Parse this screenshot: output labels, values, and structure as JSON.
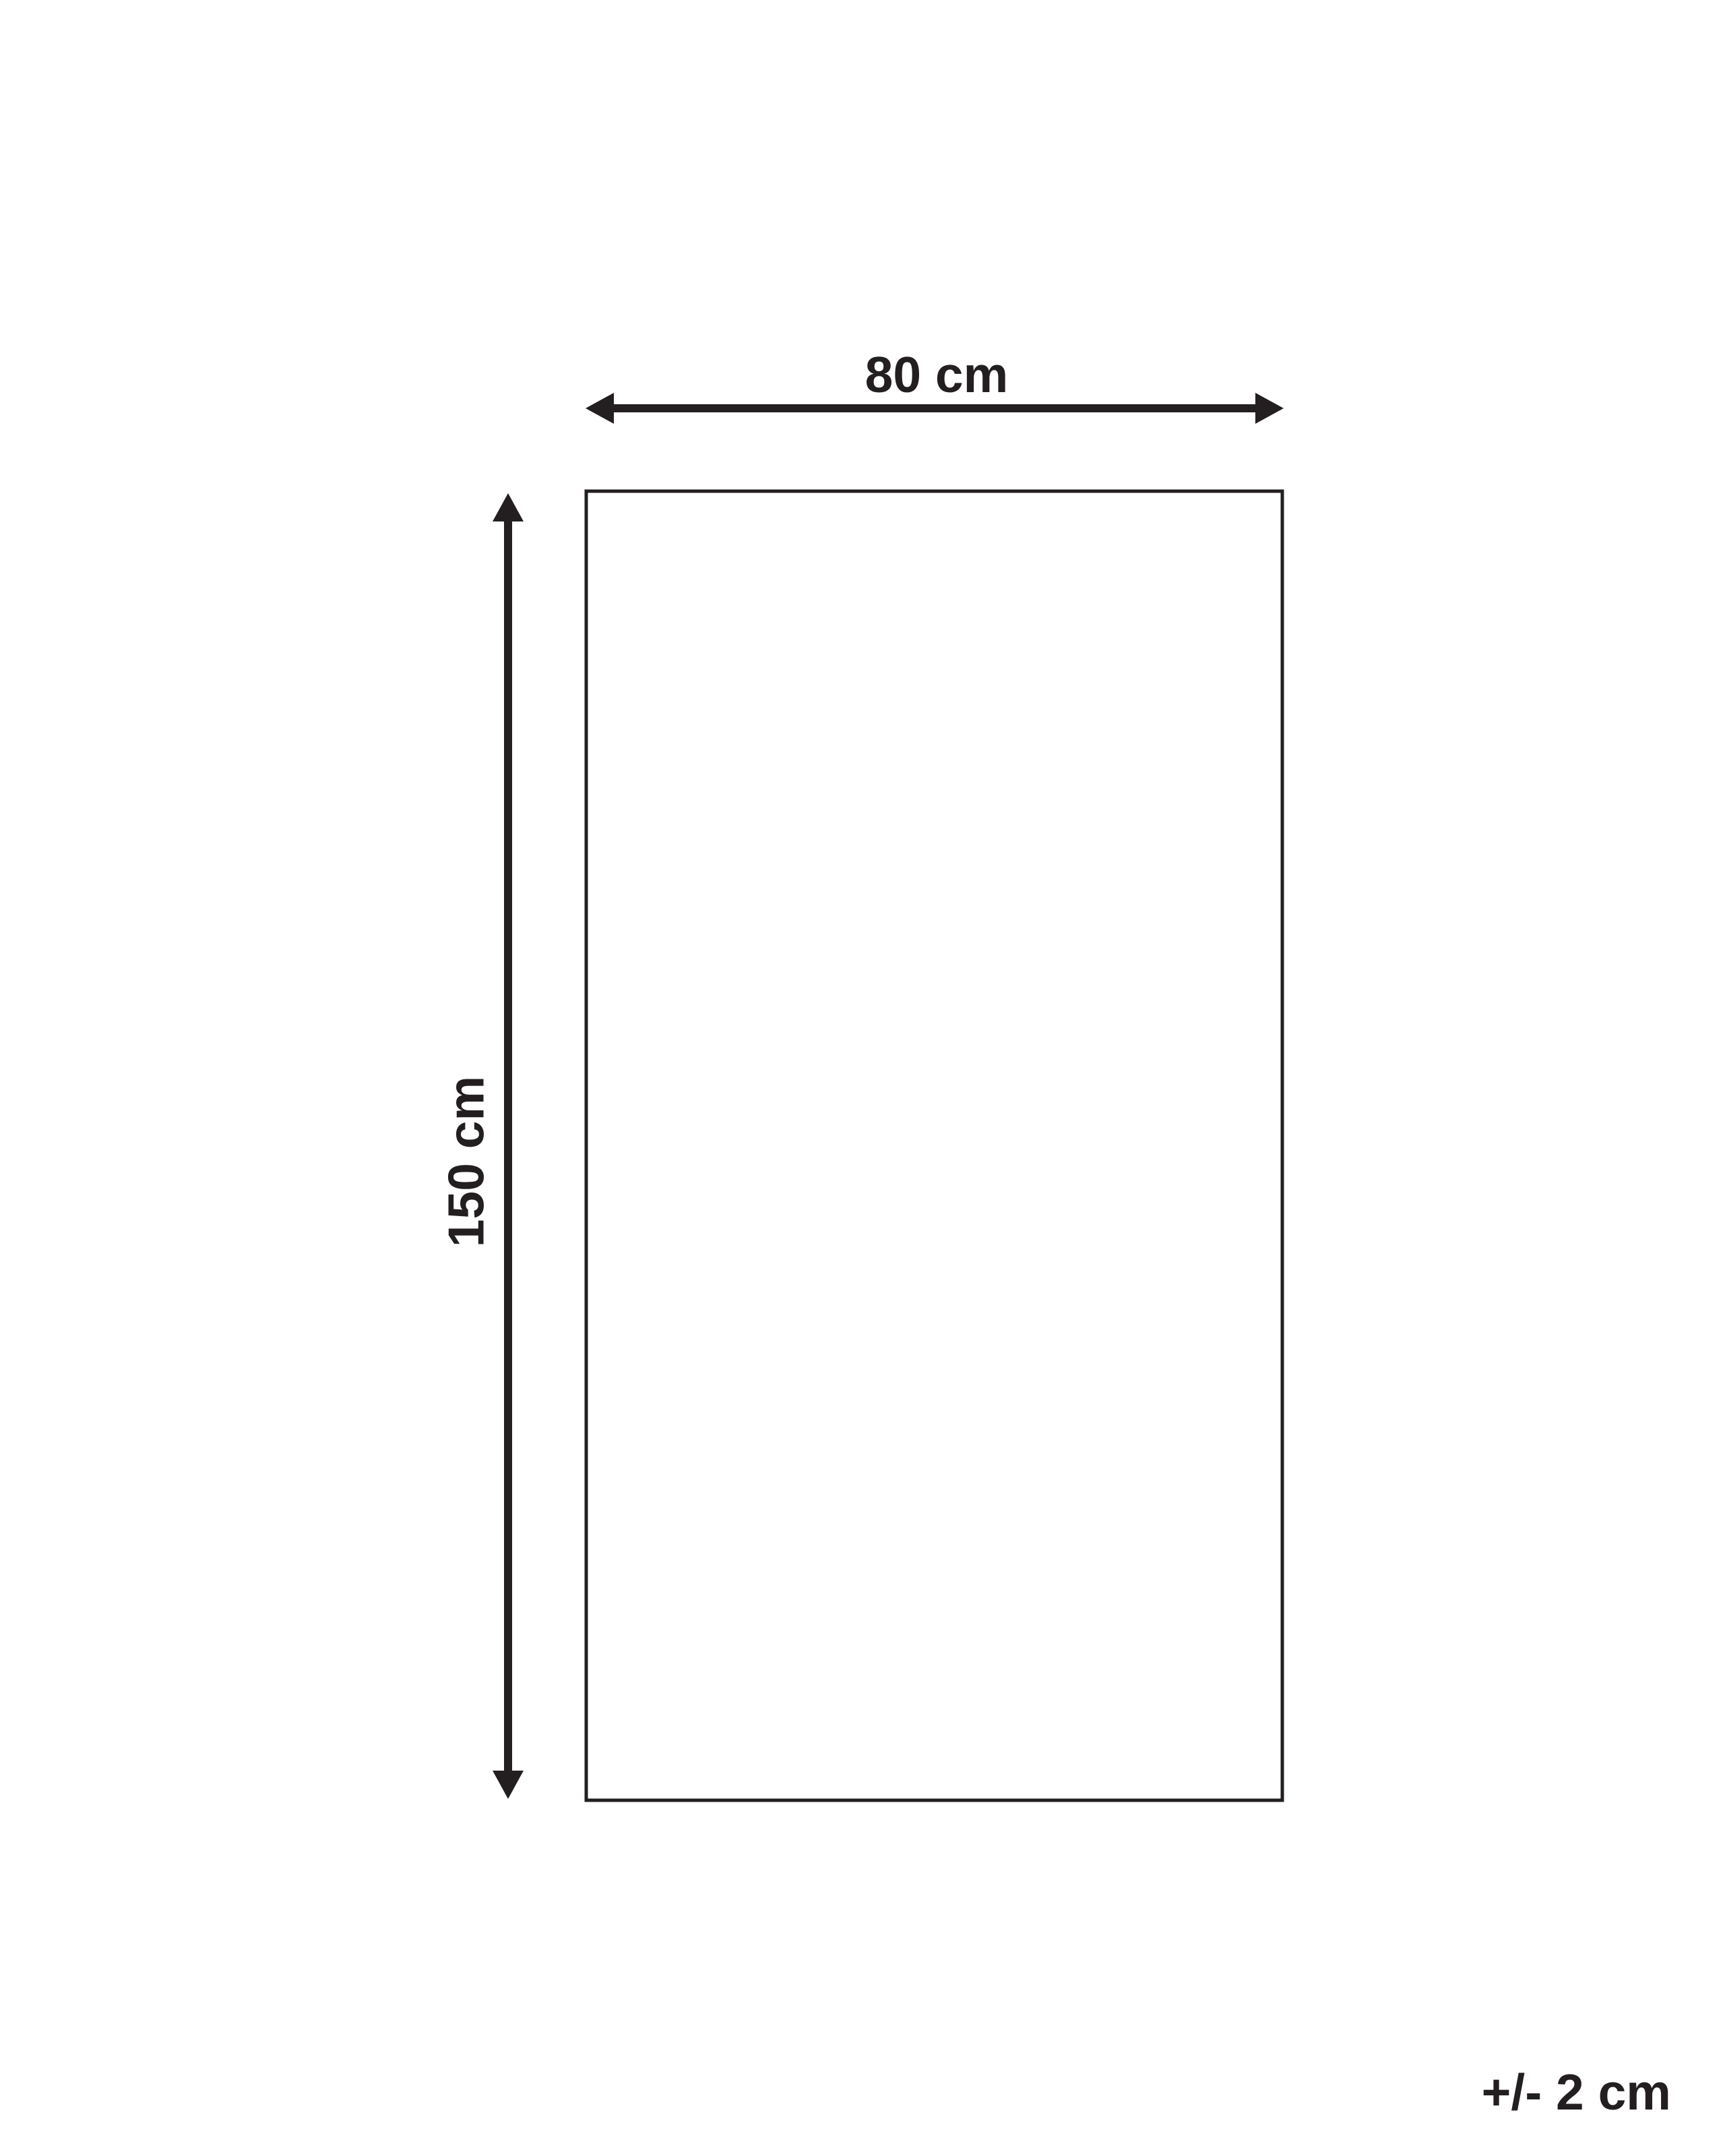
{
  "diagram": {
    "kind": "product-dimension-diagram",
    "width_label": "80 cm",
    "height_label": "150 cm",
    "tolerance_label": "+/- 2 cm",
    "dimensions": {
      "width_cm": 80,
      "height_cm": 150,
      "tolerance_cm": 2
    },
    "line_color": "#231f20",
    "background_color": "#ffffff"
  }
}
